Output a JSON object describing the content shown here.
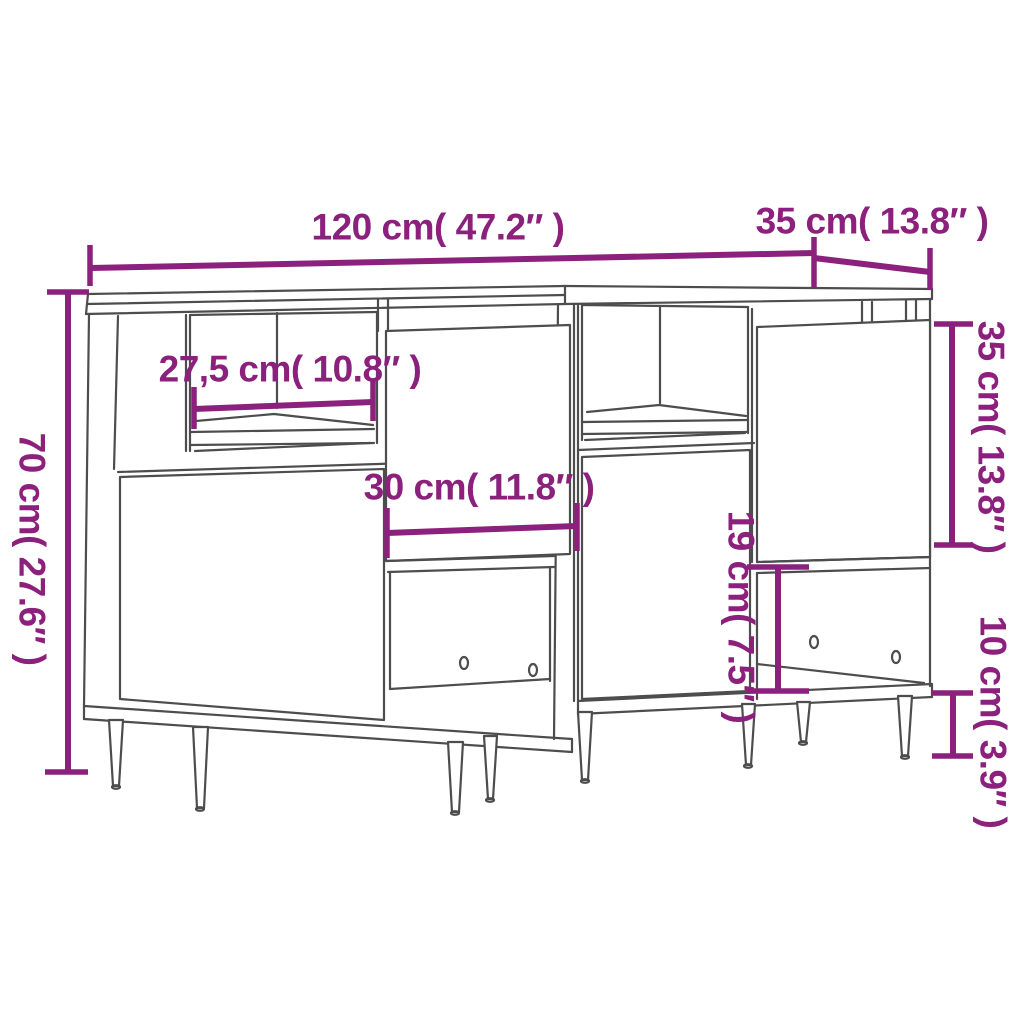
{
  "page": {
    "background_color": "#ffffff",
    "description": "Dimension diagram of a set of two sideboards with metal legs"
  },
  "style": {
    "dimension_color": "#8B217C",
    "furniture_line_color": "#4d4d4d"
  },
  "dimensions": {
    "total_width": {
      "label": "120 cm( 47.2″ )",
      "cm": "120",
      "inches": "47.2"
    },
    "depth": {
      "label": "35 cm( 13.8″ )",
      "cm": "35",
      "inches": "13.8"
    },
    "height": {
      "label": "70 cm( 27.6″ )",
      "cm": "70",
      "inches": "27.6"
    },
    "compartment_width": {
      "label": "27,5 cm( 10.8″ )",
      "cm": "27,5",
      "inches": "10.8"
    },
    "door_width": {
      "label": "30 cm( 11.8″ )",
      "cm": "30",
      "inches": "11.8"
    },
    "door_height": {
      "label": "35 cm( 13.8″ )",
      "cm": "35",
      "inches": "13.8"
    },
    "open_compartment_height": {
      "label": "19 cm( 7.5″ )",
      "cm": "19",
      "inches": "7.5"
    },
    "leg_height": {
      "label": "10 cm( 3.9″ )",
      "cm": "10",
      "inches": "3.9"
    }
  }
}
